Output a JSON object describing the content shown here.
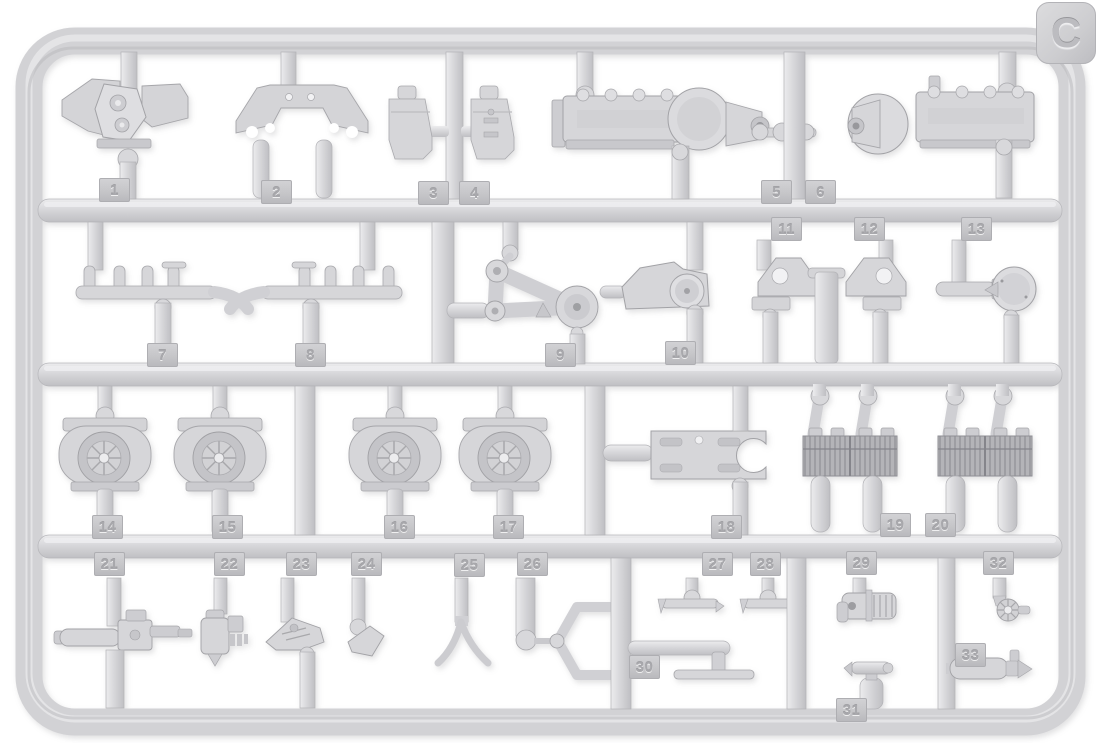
{
  "sprue": {
    "letter": "C",
    "plastic_color": "#d4d4d7",
    "tab_color": "#c6c6c9",
    "background_color": "#ffffff"
  },
  "parts": [
    {
      "id": 1,
      "label": "1"
    },
    {
      "id": 2,
      "label": "2"
    },
    {
      "id": 3,
      "label": "3"
    },
    {
      "id": 4,
      "label": "4"
    },
    {
      "id": 5,
      "label": "5"
    },
    {
      "id": 6,
      "label": "6"
    },
    {
      "id": 7,
      "label": "7"
    },
    {
      "id": 8,
      "label": "8"
    },
    {
      "id": 9,
      "label": "9"
    },
    {
      "id": 10,
      "label": "10"
    },
    {
      "id": 11,
      "label": "11"
    },
    {
      "id": 12,
      "label": "12"
    },
    {
      "id": 13,
      "label": "13"
    },
    {
      "id": 14,
      "label": "14"
    },
    {
      "id": 15,
      "label": "15"
    },
    {
      "id": 16,
      "label": "16"
    },
    {
      "id": 17,
      "label": "17"
    },
    {
      "id": 18,
      "label": "18"
    },
    {
      "id": 19,
      "label": "19"
    },
    {
      "id": 20,
      "label": "20"
    },
    {
      "id": 21,
      "label": "21"
    },
    {
      "id": 22,
      "label": "22"
    },
    {
      "id": 23,
      "label": "23"
    },
    {
      "id": 24,
      "label": "24"
    },
    {
      "id": 25,
      "label": "25"
    },
    {
      "id": 26,
      "label": "26"
    },
    {
      "id": 27,
      "label": "27"
    },
    {
      "id": 28,
      "label": "28"
    },
    {
      "id": 29,
      "label": "29"
    },
    {
      "id": 30,
      "label": "30"
    },
    {
      "id": 31,
      "label": "31"
    },
    {
      "id": 32,
      "label": "32"
    },
    {
      "id": 33,
      "label": "33"
    }
  ]
}
